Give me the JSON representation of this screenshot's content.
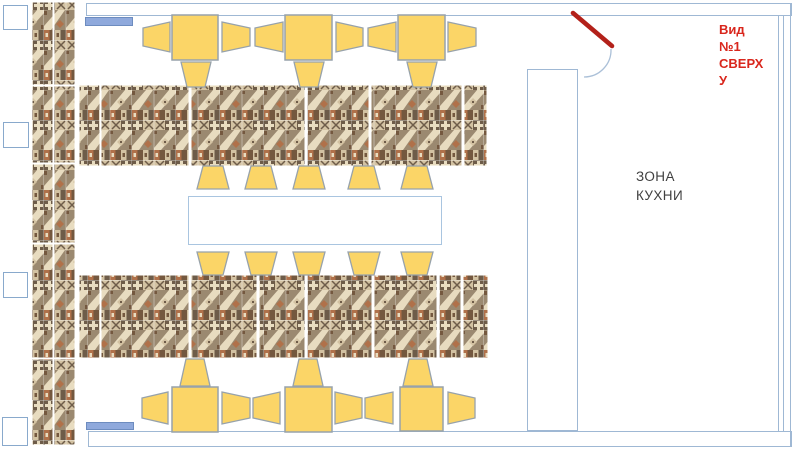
{
  "annotations": {
    "view_label": "Вид\n№1\nСВЕРХ\nУ",
    "kitchen_zone_label": "ЗОНА\nКУХНИ"
  },
  "colors": {
    "wall_border": "#9fb8d4",
    "window_border": "#89a9cc",
    "blue_marker_fill": "#8fa9dc",
    "blue_marker_border": "#6d8cbf",
    "table_yellow": "#fbd567",
    "furniture_border": "#97a2ab",
    "door_red": "#b3211a",
    "view_label_red": "#d9261c",
    "kitchen_label_color": "#3f3f3f",
    "mosaic_palette": [
      "#9b8970",
      "#6e5c49",
      "#e8dcc0",
      "#d3c2a2",
      "#b0714a",
      "#74583f"
    ]
  },
  "furniture_summary": {
    "square_tables_top": 3,
    "square_tables_bottom": 3,
    "banquette_rows": 2,
    "wall_banquette": 1,
    "long_table": 1,
    "chairs": 28,
    "windows": 4,
    "doors": 1
  }
}
